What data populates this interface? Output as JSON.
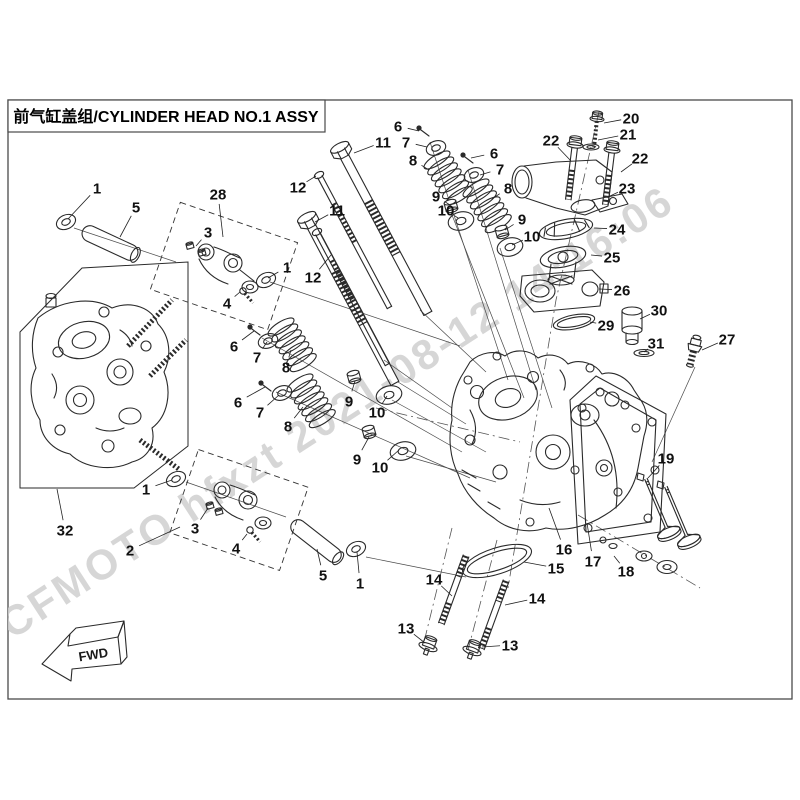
{
  "title": {
    "text": "前气缸盖组/CYLINDER HEAD NO.1 ASSY"
  },
  "watermark": {
    "text": "CFMOTO hfxzt 2021-08-12 14:16:06",
    "color": "#d0d0d0"
  },
  "fwd_label": "FWD",
  "line_color": "#2a2a2a",
  "callouts": [
    {
      "n": "1",
      "x": 97,
      "y": 188,
      "tx": 68,
      "ty": 219
    },
    {
      "n": "5",
      "x": 136,
      "y": 207,
      "tx": 120,
      "ty": 237
    },
    {
      "n": "28",
      "x": 218,
      "y": 194,
      "tx": 223,
      "ty": 237
    },
    {
      "n": "3",
      "x": 208,
      "y": 232,
      "tx": 196,
      "ty": 246
    },
    {
      "n": "4",
      "x": 227,
      "y": 303,
      "tx": 240,
      "ty": 292
    },
    {
      "n": "1",
      "x": 287,
      "y": 267,
      "tx": 268,
      "ty": 278
    },
    {
      "n": "12",
      "x": 298,
      "y": 187,
      "tx": 316,
      "ty": 176
    },
    {
      "n": "11",
      "x": 383,
      "y": 142,
      "tx": 354,
      "ty": 153
    },
    {
      "n": "11",
      "x": 337,
      "y": 210,
      "tx": 315,
      "ty": 222
    },
    {
      "n": "12",
      "x": 313,
      "y": 277,
      "tx": 331,
      "ty": 255
    },
    {
      "n": "6",
      "x": 398,
      "y": 126,
      "tx": 419,
      "ty": 131
    },
    {
      "n": "7",
      "x": 406,
      "y": 142,
      "tx": 427,
      "ty": 147
    },
    {
      "n": "8",
      "x": 413,
      "y": 160,
      "tx": 429,
      "ty": 170
    },
    {
      "n": "6",
      "x": 494,
      "y": 153,
      "tx": 471,
      "ty": 158
    },
    {
      "n": "7",
      "x": 500,
      "y": 169,
      "tx": 480,
      "ty": 175
    },
    {
      "n": "8",
      "x": 508,
      "y": 188,
      "tx": 492,
      "ty": 199
    },
    {
      "n": "9",
      "x": 436,
      "y": 196,
      "tx": 450,
      "ty": 205
    },
    {
      "n": "10",
      "x": 446,
      "y": 210,
      "tx": 458,
      "ty": 218
    },
    {
      "n": "9",
      "x": 522,
      "y": 219,
      "tx": 505,
      "ty": 230
    },
    {
      "n": "10",
      "x": 532,
      "y": 236,
      "tx": 512,
      "ty": 245
    },
    {
      "n": "20",
      "x": 631,
      "y": 118,
      "tx": 604,
      "ty": 123
    },
    {
      "n": "21",
      "x": 628,
      "y": 134,
      "tx": 598,
      "ty": 140
    },
    {
      "n": "22",
      "x": 551,
      "y": 140,
      "tx": 571,
      "ty": 161
    },
    {
      "n": "22",
      "x": 640,
      "y": 158,
      "tx": 621,
      "ty": 172
    },
    {
      "n": "23",
      "x": 627,
      "y": 188,
      "tx": 608,
      "ty": 197
    },
    {
      "n": "24",
      "x": 617,
      "y": 229,
      "tx": 594,
      "ty": 228
    },
    {
      "n": "25",
      "x": 612,
      "y": 257,
      "tx": 591,
      "ty": 255
    },
    {
      "n": "26",
      "x": 622,
      "y": 290,
      "tx": 599,
      "ty": 289
    },
    {
      "n": "29",
      "x": 606,
      "y": 325,
      "tx": 590,
      "ty": 322
    },
    {
      "n": "30",
      "x": 659,
      "y": 310,
      "tx": 640,
      "ty": 319
    },
    {
      "n": "31",
      "x": 656,
      "y": 343,
      "tx": 644,
      "ty": 352
    },
    {
      "n": "27",
      "x": 727,
      "y": 339,
      "tx": 702,
      "ty": 350
    },
    {
      "n": "6",
      "x": 234,
      "y": 346,
      "tx": 254,
      "ty": 331
    },
    {
      "n": "7",
      "x": 257,
      "y": 357,
      "tx": 267,
      "ty": 342
    },
    {
      "n": "8",
      "x": 286,
      "y": 367,
      "tx": 291,
      "ty": 350
    },
    {
      "n": "9",
      "x": 349,
      "y": 401,
      "tx": 355,
      "ty": 381
    },
    {
      "n": "10",
      "x": 377,
      "y": 412,
      "tx": 387,
      "ty": 396
    },
    {
      "n": "6",
      "x": 238,
      "y": 402,
      "tx": 265,
      "ty": 387
    },
    {
      "n": "7",
      "x": 260,
      "y": 412,
      "tx": 279,
      "ty": 395
    },
    {
      "n": "8",
      "x": 288,
      "y": 426,
      "tx": 303,
      "ty": 407
    },
    {
      "n": "9",
      "x": 357,
      "y": 459,
      "tx": 369,
      "ty": 437
    },
    {
      "n": "10",
      "x": 380,
      "y": 467,
      "tx": 399,
      "ty": 450
    },
    {
      "n": "1",
      "x": 146,
      "y": 489,
      "tx": 172,
      "ty": 480
    },
    {
      "n": "32",
      "x": 65,
      "y": 530,
      "tx": 57,
      "ty": 489
    },
    {
      "n": "2",
      "x": 130,
      "y": 550,
      "tx": 180,
      "ty": 527
    },
    {
      "n": "3",
      "x": 195,
      "y": 528,
      "tx": 208,
      "ty": 508
    },
    {
      "n": "4",
      "x": 236,
      "y": 548,
      "tx": 247,
      "ty": 534
    },
    {
      "n": "5",
      "x": 323,
      "y": 575,
      "tx": 317,
      "ty": 549
    },
    {
      "n": "1",
      "x": 360,
      "y": 583,
      "tx": 357,
      "ty": 552
    },
    {
      "n": "19",
      "x": 666,
      "y": 458,
      "tx": 648,
      "ty": 478
    },
    {
      "n": "16",
      "x": 564,
      "y": 549,
      "tx": 549,
      "ty": 508
    },
    {
      "n": "17",
      "x": 593,
      "y": 561,
      "tx": 587,
      "ty": 523
    },
    {
      "n": "15",
      "x": 556,
      "y": 568,
      "tx": 524,
      "ty": 562
    },
    {
      "n": "18",
      "x": 626,
      "y": 571,
      "tx": 614,
      "ty": 556
    },
    {
      "n": "14",
      "x": 434,
      "y": 579,
      "tx": 452,
      "ty": 596
    },
    {
      "n": "14",
      "x": 537,
      "y": 598,
      "tx": 505,
      "ty": 605
    },
    {
      "n": "13",
      "x": 406,
      "y": 628,
      "tx": 425,
      "ty": 643
    },
    {
      "n": "13",
      "x": 510,
      "y": 645,
      "tx": 482,
      "ty": 647
    }
  ]
}
